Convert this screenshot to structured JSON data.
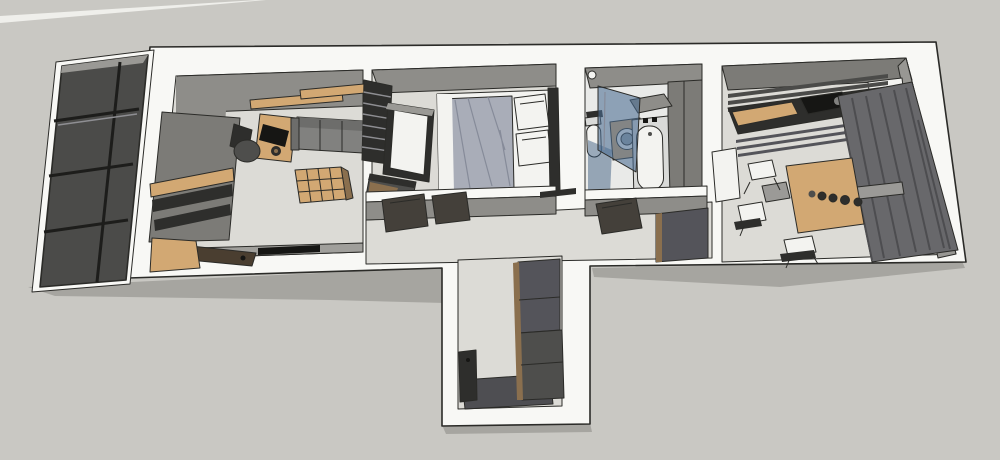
{
  "app": {
    "type": "3d-floorplan-render",
    "description": "Axonometric cutaway (dollhouse) view of a small apartment interior with balcony, living room, bedroom, bathroom, hallway, entry vestibule and kitchen-dining room"
  },
  "colors": {
    "bg": "#c9c8c3",
    "sliver": "#efefeb",
    "shadow": "#a6a5a0",
    "wall": "#f8f8f5",
    "edge": "#2b2b28",
    "wallface": "#8e8d89",
    "wallface_light": "#a09f9b",
    "wallface_dark": "#7c7b77",
    "floor": "#dcdbd6",
    "floor_bath": "#e9eae8",
    "balcony": "#4b4b49",
    "pane_frame": "#1d1d1b",
    "roofgray": "#9a9995",
    "wood": "#d2a873",
    "wood_dark": "#8a6f4e",
    "wood_brown": "#4a3e30",
    "dark": "#4e4e4c",
    "darker": "#2e2e2c",
    "black": "#161614",
    "sofa": "#81817f",
    "sofa_back": "#6d6d6b",
    "duvet": "#a9adb8",
    "duvet_line": "#868b99",
    "white_soft": "#f3f3f0",
    "glass": "#4a6d92",
    "glass_deep": "#2e5377",
    "tubdeck": "#d9dad8",
    "steel": "#9aa4ab",
    "curtain": "#68686b",
    "curtain_fold": "#4d4d50",
    "wallright": "#989793",
    "table_gray": "#9b9a97",
    "door": "#44403a",
    "mat": "#4e4e52",
    "cab": "#54545a",
    "slatline": "#8e8e92"
  },
  "scene": {
    "exterior": [
      "balcony-glazing"
    ],
    "rooms": [
      {
        "name": "living-room",
        "furniture": [
          "wall-wardrobe",
          "wood-shelf-band",
          "bench",
          "floating-shelves",
          "desk",
          "monitor",
          "office-chair",
          "sofa",
          "cube-shelf",
          "media-bar"
        ]
      },
      {
        "name": "bedroom",
        "furniture": [
          "ladder-shelf",
          "wardrobe",
          "low-cabinet",
          "double-bed",
          "duvet",
          "pillows",
          "headboard"
        ]
      },
      {
        "name": "bathroom",
        "furniture": [
          "toilet",
          "shower-glass-screen",
          "washing-machine",
          "bathtub",
          "wall-shelf",
          "ceiling-light"
        ]
      },
      {
        "name": "hallway",
        "furniture": [
          "open-door-bedroom",
          "open-door-living",
          "open-door-bathroom",
          "shoe-cabinet"
        ]
      },
      {
        "name": "entry-vestibule",
        "furniture": [
          "tall-cabinet",
          "coat-rack",
          "door-mat"
        ]
      },
      {
        "name": "kitchen-dining",
        "furniture": [
          "slatted-shelves",
          "counter",
          "cutting-board",
          "cooktop",
          "white-door-leaf",
          "dining-table",
          "bottles",
          "tray",
          "chairs",
          "curtain"
        ]
      }
    ]
  }
}
